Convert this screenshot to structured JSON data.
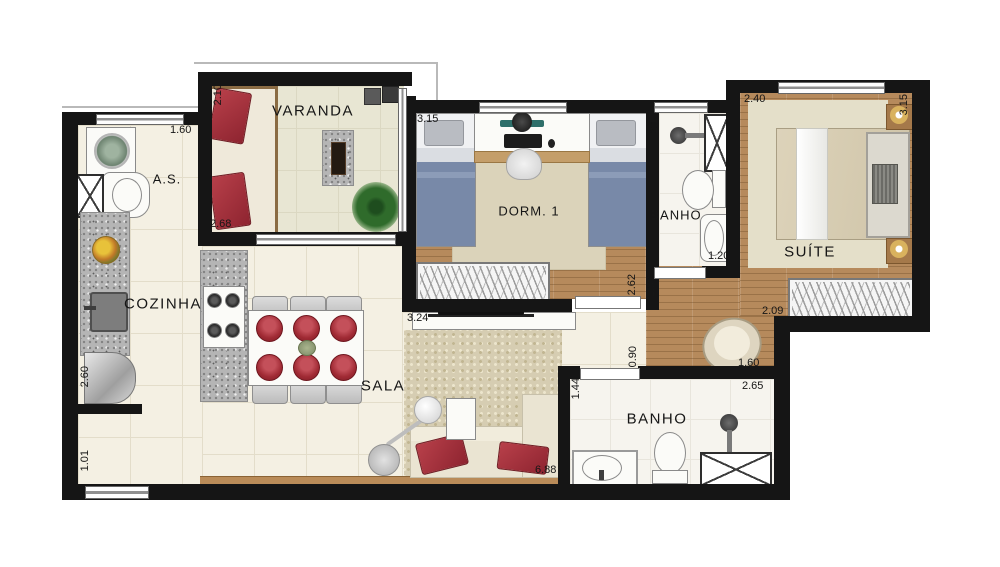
{
  "title": "Apartment floor plan",
  "rooms": {
    "varanda": "VARANDA",
    "area_servico": "A.S.",
    "cozinha": "COZINHA",
    "sala": "SALA",
    "dorm1": "DORM. 1",
    "banho1": "BANHO",
    "suite": "SUÍTE",
    "banho2": "BANHO"
  },
  "dims": {
    "as_top": "1.60",
    "varanda_left": "2.10",
    "varanda_bottom": "2.68",
    "dorm1_top": "3.15",
    "dorm1_right": "2.62",
    "dorm1_bottom": "3.24",
    "banho1_left": "2.15",
    "banho1_bottom": "1.20",
    "suite_top": "2.40",
    "suite_right": "3.15",
    "suite_bottom": "2.09",
    "hall_upper": "1.37",
    "hall_lower": "0.90",
    "hall_width": "1.60",
    "banho2_top": "2.65",
    "banho2_left": "1.44",
    "sala_bottom": "6.88",
    "cozinha_left": "2.60",
    "entry_left": "1.01"
  },
  "palette": {
    "wall": "#151515",
    "tile_floor": "#f4f0e3",
    "wood_floor": "#b68a5c",
    "varanda_floor": "#e8e6d3",
    "rug": "#dbd3ba",
    "accent_red": "#a93236",
    "bed_blue": "#7889a8",
    "lamp_gold": "#d9b25e"
  }
}
